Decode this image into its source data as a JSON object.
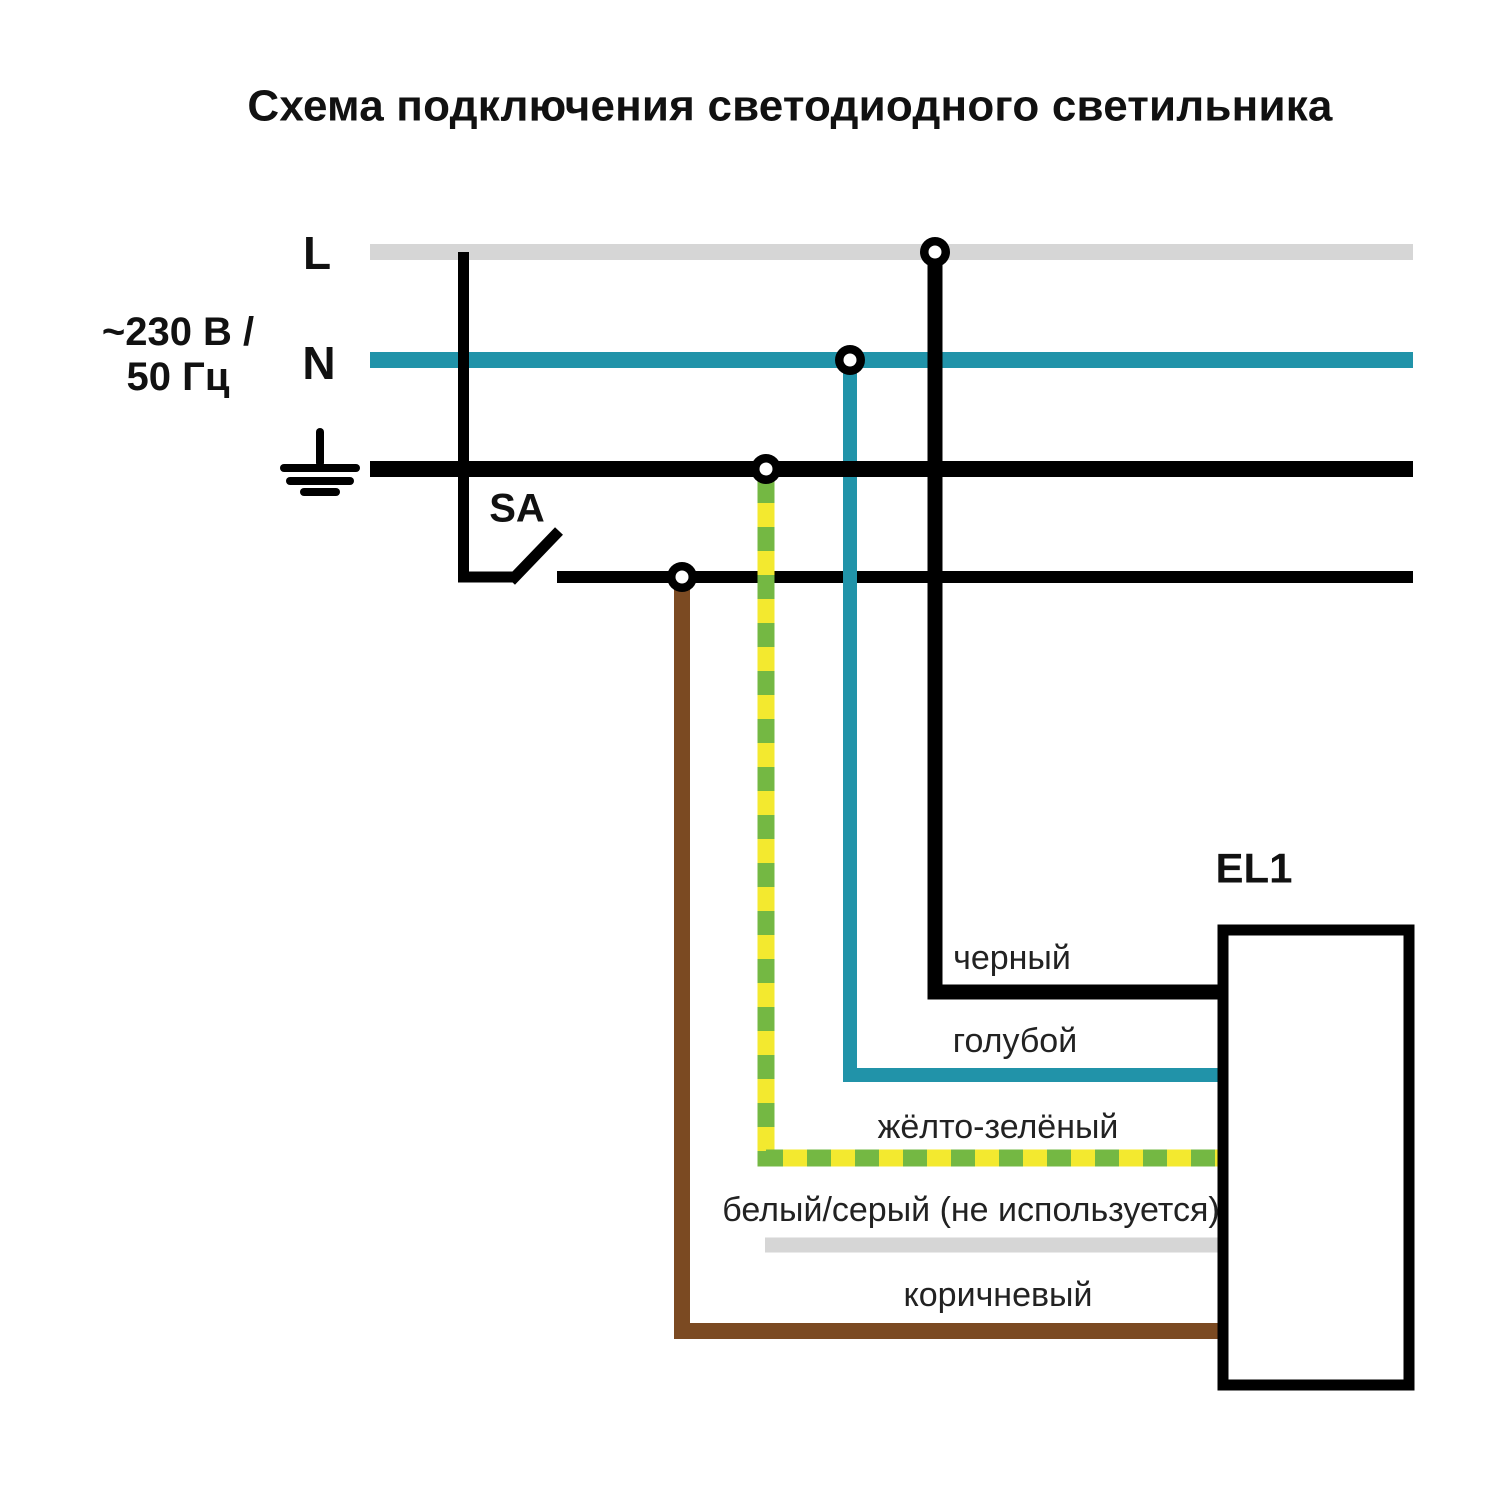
{
  "title": "Схема подключения светодиодного светильника",
  "supply": {
    "rating_line1": "~230 В /",
    "rating_line2": "50 Гц",
    "phase_label": "L",
    "neutral_label": "N"
  },
  "switch_label": "SA",
  "luminaire_label": "EL1",
  "wires": {
    "black": "черный",
    "blue": "голубой",
    "yellow_green": "жёлто-зелёный",
    "white_gray": "белый/серый (не используется)",
    "brown": "коричневый"
  },
  "colors": {
    "phase_gray": "#d6d6d6",
    "neutral_teal": "#2193a9",
    "black": "#000000",
    "pe_yellow": "#f3e92f",
    "pe_green": "#74b843",
    "brown": "#7b4a22",
    "unused_gray": "#d6d6d6"
  }
}
